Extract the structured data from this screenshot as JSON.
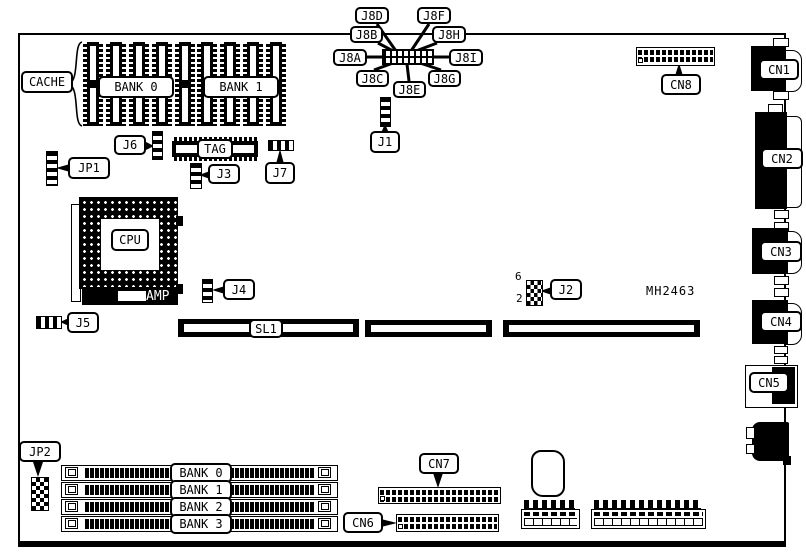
{
  "diagram": {
    "part_number": "MH2463",
    "cache_area": {
      "label": "CACHE",
      "bank0": "BANK 0",
      "bank1": "BANK 1",
      "tag": "TAG"
    },
    "cpu_area": {
      "cpu": "CPU",
      "socket": "AMP"
    },
    "slots": {
      "sl1": "SL1"
    },
    "memory": {
      "bank0": "BANK 0",
      "bank1": "BANK 1",
      "bank2": "BANK 2",
      "bank3": "BANK 3"
    },
    "jumpers": {
      "j1": "J1",
      "j2": "J2",
      "j2_pin_top": "6",
      "j2_pin_bottom": "2",
      "j3": "J3",
      "j4": "J4",
      "j5": "J5",
      "j6": "J6",
      "j7": "J7",
      "jp1": "JP1",
      "jp2": "JP2",
      "j8a": "J8A",
      "j8b": "J8B",
      "j8c": "J8C",
      "j8d": "J8D",
      "j8e": "J8E",
      "j8f": "J8F",
      "j8g": "J8G",
      "j8h": "J8H",
      "j8i": "J8I"
    },
    "connectors": {
      "cn1": "CN1",
      "cn2": "CN2",
      "cn3": "CN3",
      "cn4": "CN4",
      "cn5": "CN5",
      "cn6": "CN6",
      "cn7": "CN7",
      "cn8": "CN8"
    },
    "colors": {
      "ink": "#000000",
      "paper": "#ffffff"
    }
  }
}
